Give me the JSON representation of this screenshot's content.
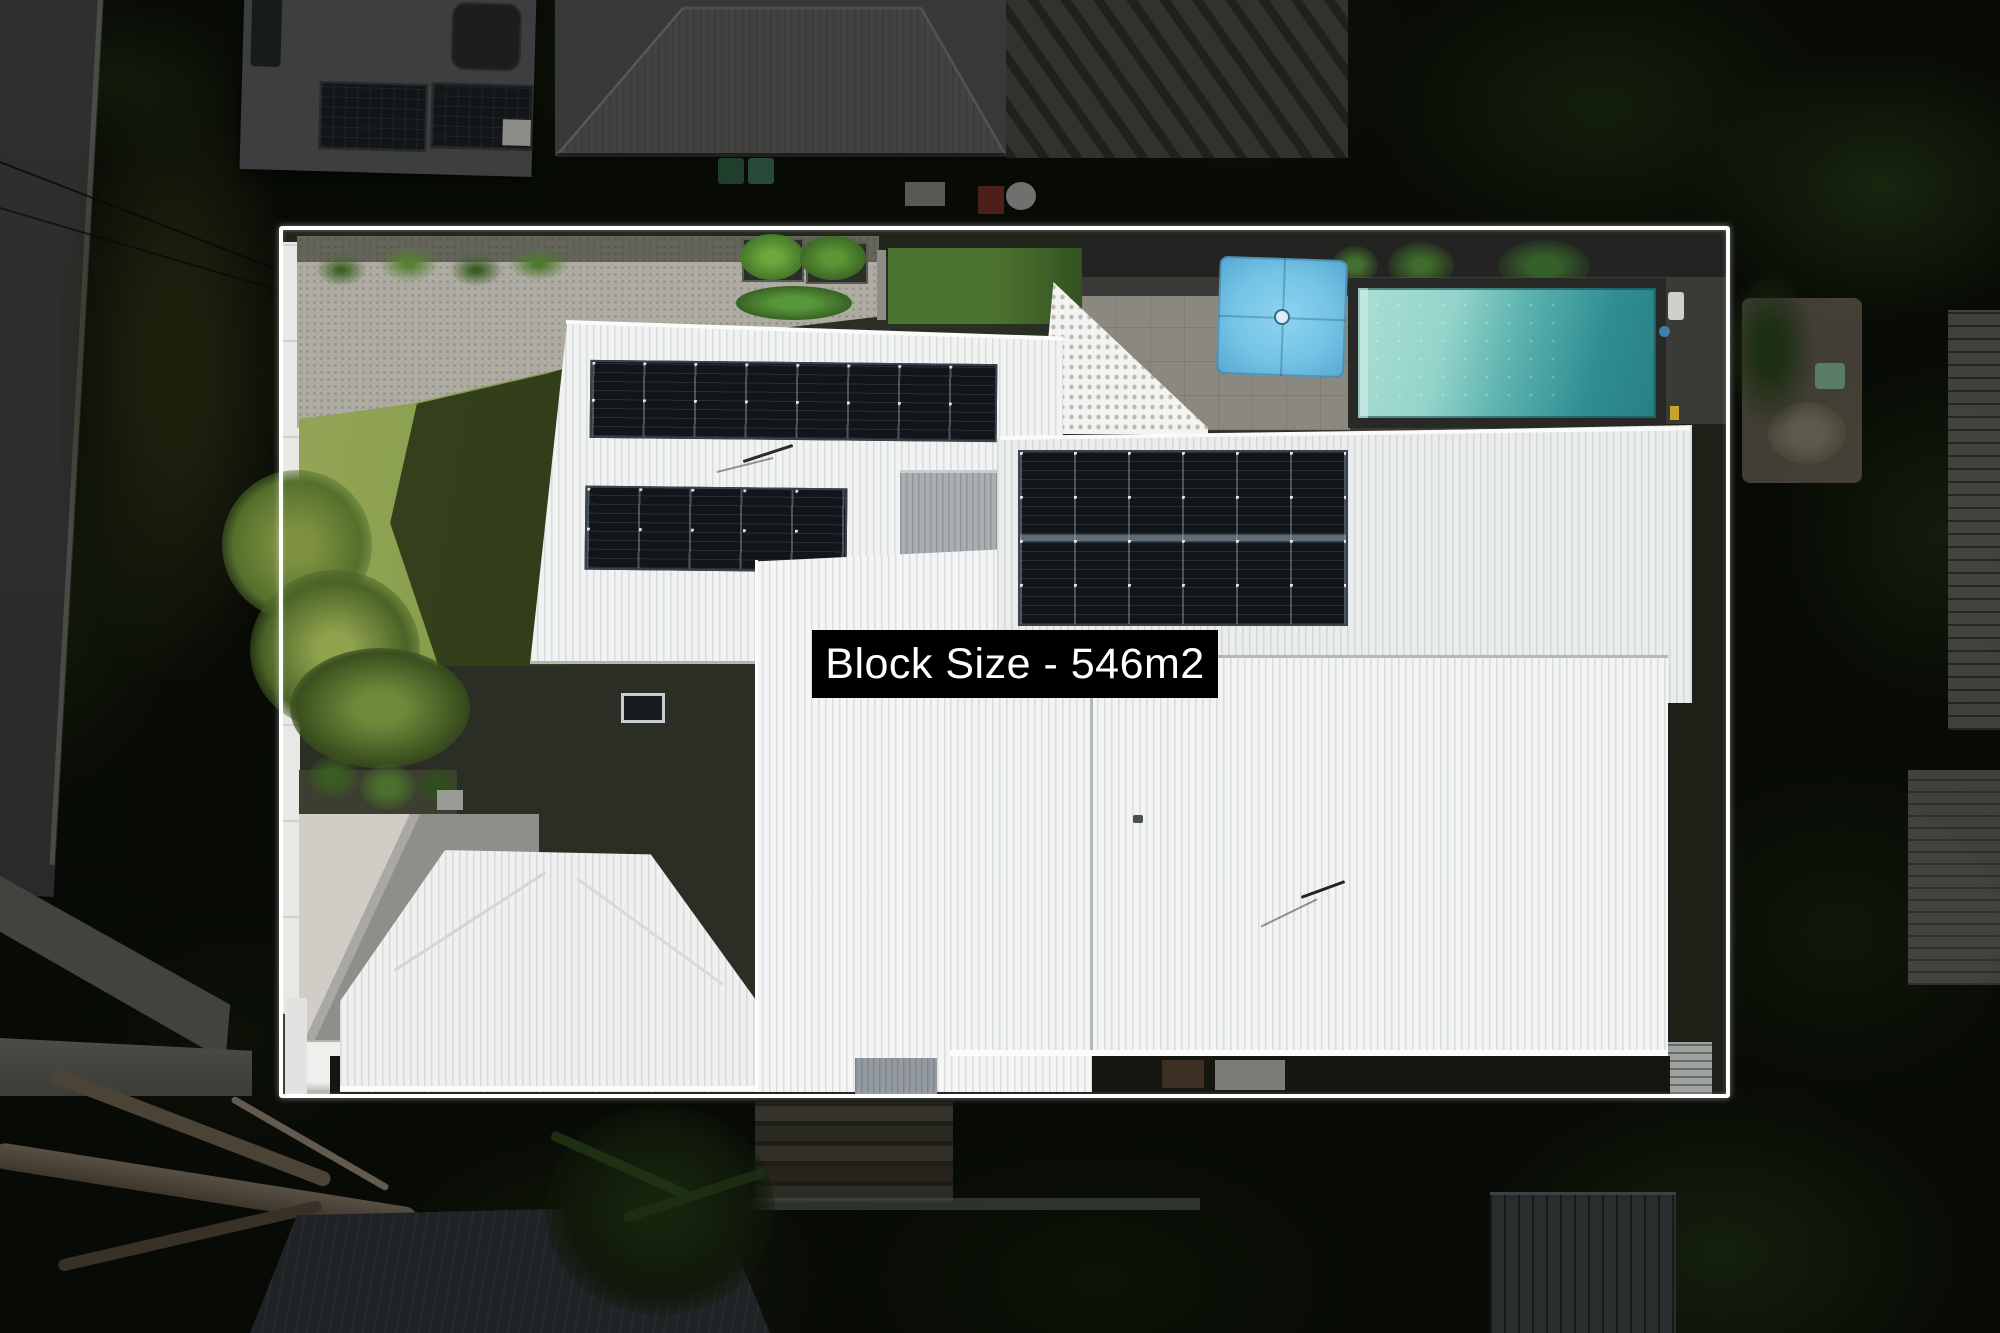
{
  "overlay": {
    "label": "Block Size - 546m2",
    "label_bg": "#000000",
    "label_text_color": "#ffffff"
  },
  "boundary": {
    "line_color": "#ffffff"
  },
  "palette": {
    "roof_white": "#f2f4f3",
    "solar_panel_dark": "#14171c",
    "pool_water_light": "#abded4",
    "pool_water_dark": "#2f8e92",
    "umbrella_blue": "#74c4e6",
    "lawn_green_sunlit": "#8ba14f",
    "lawn_green_shadow": "#333f1c",
    "gravel_gray": "#aeaba2",
    "driveway_concrete": "#cfcdc5",
    "neighbor_roof_gray": "#5c5c5a",
    "vegetation_dark": "#0b0e07",
    "pool_terrace_charcoal": "#2c2c2a"
  },
  "scene": {
    "type": "aerial-property-photo",
    "solar_arrays": [
      {
        "location": "upper-left roof",
        "panels": 8,
        "rows": 1
      },
      {
        "location": "mid-left roof",
        "panels": 5,
        "rows": 1
      },
      {
        "location": "right roof",
        "panels": 12,
        "rows": 2
      },
      {
        "location": "lower-left roof",
        "panels": 1,
        "rows": 1
      }
    ]
  }
}
